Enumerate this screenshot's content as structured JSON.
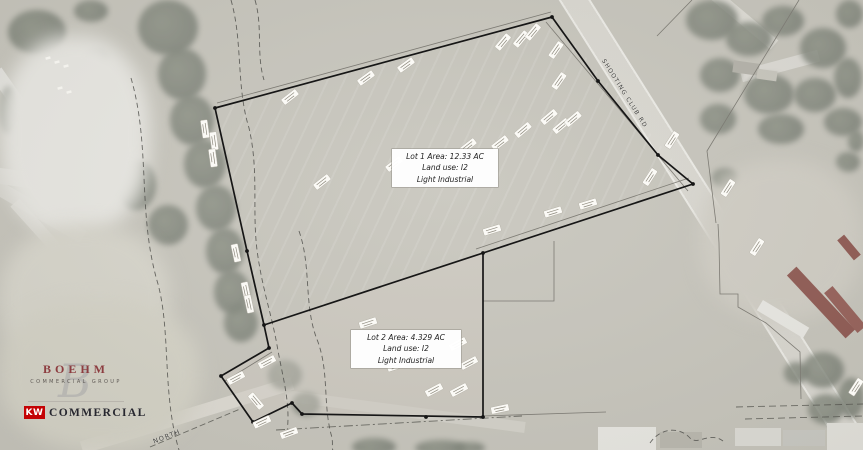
{
  "map": {
    "lots": [
      {
        "id": "lot-1",
        "line1": "Lot 1 Area: 12.33 AC",
        "line2": "Land use: I2",
        "line3": "Light Industrial"
      },
      {
        "id": "lot-2",
        "line1": "Lot 2 Area: 4.329 AC",
        "line2": "Land use: I2",
        "line3": "Light Industrial"
      }
    ],
    "roads": [
      {
        "id": "shooting-club-rd",
        "label": "SHOOTING CLUB RD"
      },
      {
        "id": "north-road",
        "label": "NORTH"
      }
    ]
  },
  "branding": {
    "boehm": {
      "title": "BOEHM",
      "subtitle": "COMMERCIAL GROUP",
      "monogram": "B",
      "accent_color": "#8d3d40"
    },
    "kw": {
      "mark": "KW",
      "title": "COMMERCIAL",
      "accent_color": "#c40204"
    }
  }
}
